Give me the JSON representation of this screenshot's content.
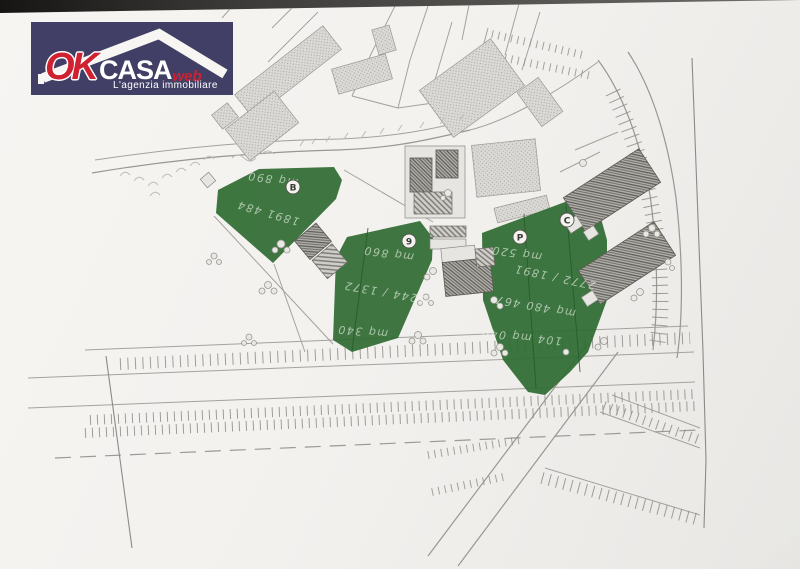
{
  "logo": {
    "brand_ok": "OK",
    "brand_casa": "CASA",
    "brand_web": "web",
    "tagline": "L'agenzia immobiliare",
    "bg_color": "#413f66",
    "accent_red": "#cf2130"
  },
  "map": {
    "highlight_color": "#2f6c33",
    "paper_color": "#f4f2ef",
    "parcels": [
      {
        "label": "B"
      },
      {
        "label": "9"
      },
      {
        "label": "P"
      },
      {
        "label": "C"
      }
    ],
    "annotations": {
      "b": [
        "mq 890",
        "1891 484"
      ],
      "p9": [
        "mq 860",
        "1244 / 1372",
        "mq 340"
      ],
      "pc": [
        "mq 520",
        "2772 / 1891",
        "mq 480 467",
        "104 mq 040"
      ]
    }
  }
}
